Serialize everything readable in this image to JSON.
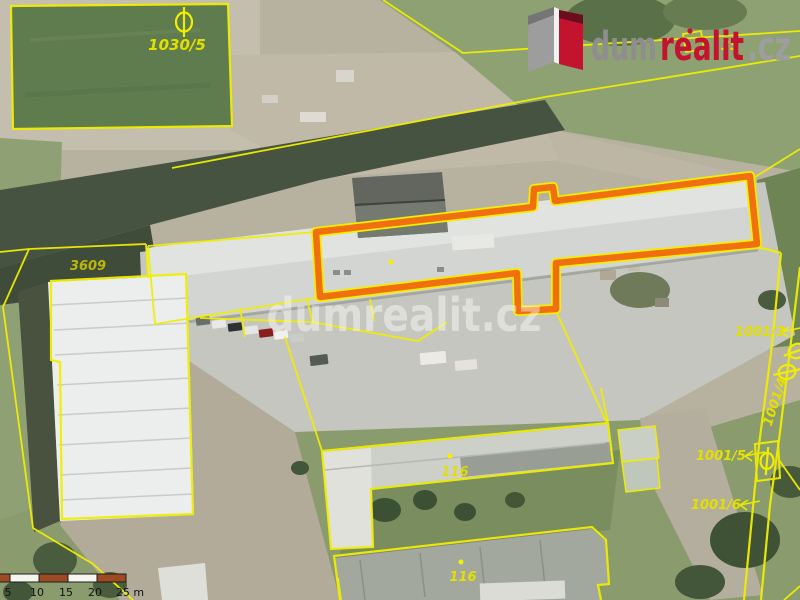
{
  "branding": {
    "logo": {
      "part_dum": "dum",
      "part_realit": "realit",
      "part_cz": ".cz",
      "red": "#c3132e",
      "gray": "#8e8e8e",
      "icon": "door-logo-icon"
    },
    "watermark": "dumrealit.cz"
  },
  "map": {
    "type": "aerial-cadastral-map",
    "highlight_color": "#f07010",
    "parcel_line_color": "#f0ee00",
    "labels": {
      "pond_parcel": "1030/5",
      "left_parcel": "3609",
      "building_a": "116",
      "building_b": "116",
      "parcel_r3": "1001/3",
      "parcel_r4": "1001/4",
      "parcel_r5": "1001/5",
      "parcel_r6": "1001/6",
      "partial_top": "35"
    }
  },
  "scalebar": {
    "labels": [
      "5",
      "10",
      "15",
      "20",
      "25 m"
    ],
    "segment_dark": "#9d4a22",
    "segment_light": "#f5f5ef"
  }
}
